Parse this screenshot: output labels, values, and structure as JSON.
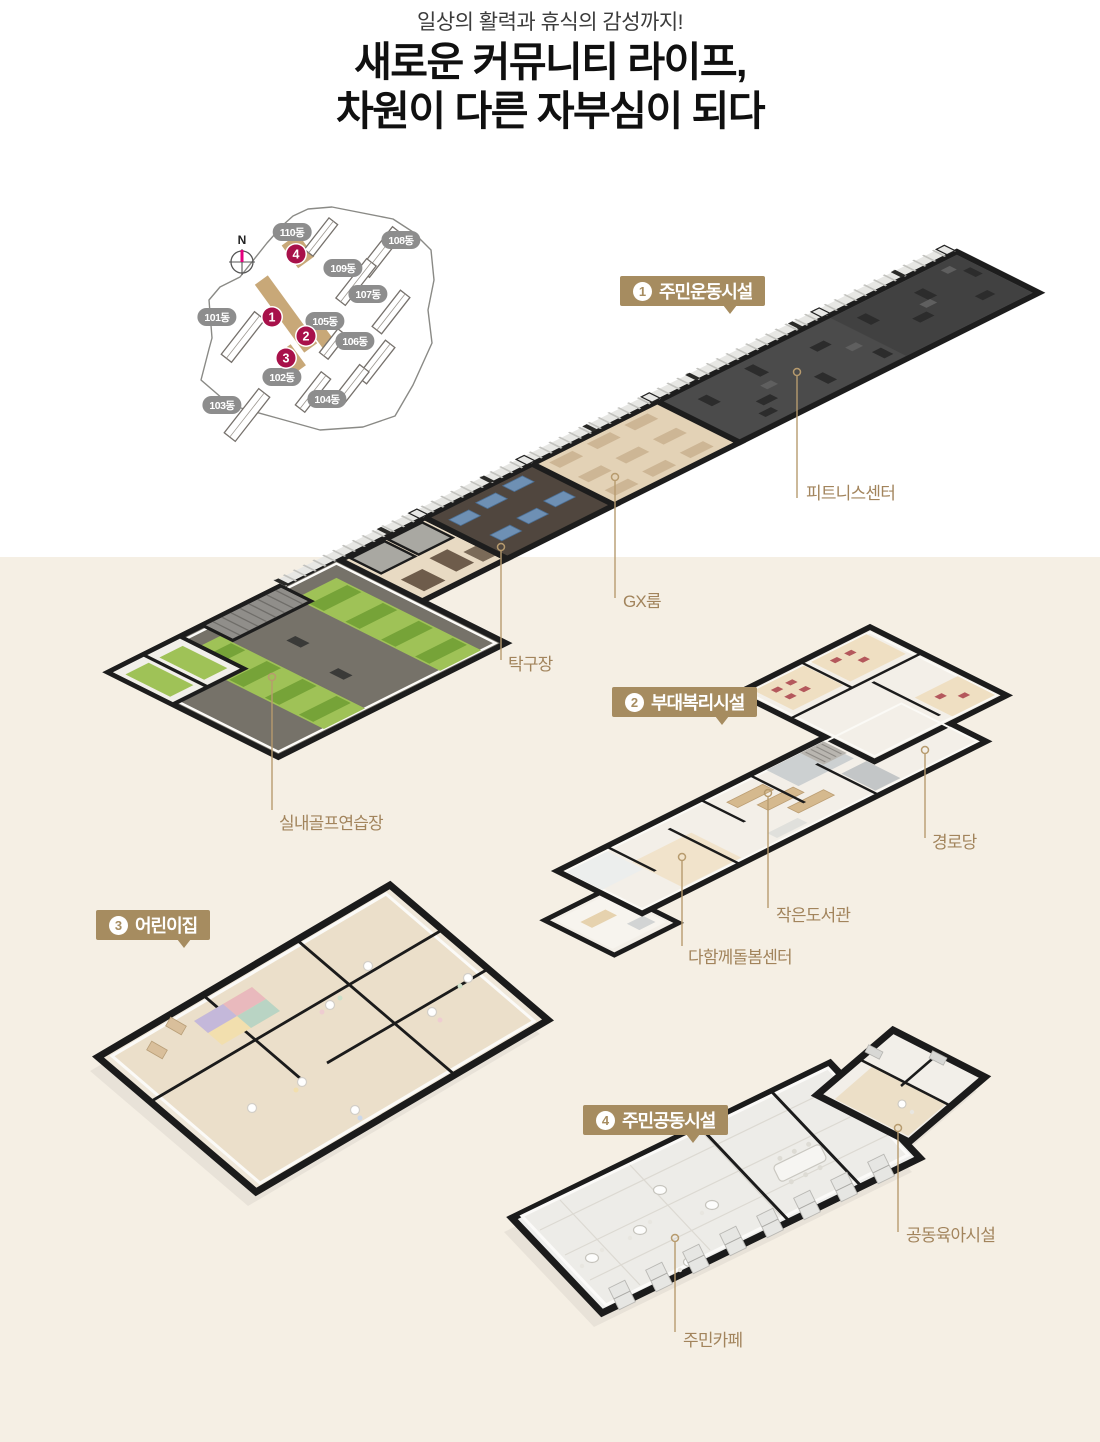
{
  "header": {
    "subtitle": "일상의 활력과 휴식의 감성까지!",
    "title_line1": "새로운 커뮤니티 라이프,",
    "title_line2": "차원이 다른 자부심이 되다"
  },
  "sitemap": {
    "compass_label": "N",
    "buildings": [
      {
        "label": "110동"
      },
      {
        "label": "108동"
      },
      {
        "label": "109동"
      },
      {
        "label": "107동"
      },
      {
        "label": "101동"
      },
      {
        "label": "105동"
      },
      {
        "label": "106동"
      },
      {
        "label": "102동"
      },
      {
        "label": "104동"
      },
      {
        "label": "103동"
      }
    ],
    "markers": [
      {
        "number": "1"
      },
      {
        "number": "2"
      },
      {
        "number": "3"
      },
      {
        "number": "4"
      }
    ]
  },
  "facilities": [
    {
      "number": "1",
      "name": "주민운동시설",
      "rooms": [
        {
          "label": "피트니스센터"
        },
        {
          "label": "GX룸"
        },
        {
          "label": "탁구장"
        },
        {
          "label": "실내골프연습장"
        }
      ]
    },
    {
      "number": "2",
      "name": "부대복리시설",
      "rooms": [
        {
          "label": "경로당"
        },
        {
          "label": "작은도서관"
        },
        {
          "label": "다함께돌봄센터"
        }
      ]
    },
    {
      "number": "3",
      "name": "어린이집",
      "rooms": []
    },
    {
      "number": "4",
      "name": "주민공동시설",
      "rooms": [
        {
          "label": "공동육아시설"
        },
        {
          "label": "주민카페"
        }
      ]
    }
  ],
  "colors": {
    "badge_tan": "#a68c60",
    "label_gold": "#a2845c",
    "marker_crimson": "#a8114a",
    "facility_tan": "#c8a878",
    "compass_north": "#e5007e",
    "background_cream": "#f5efe4",
    "turf_green": "#9fc257",
    "fitness_floor": "#4b4b4b",
    "table_tennis_floor": "#50463e",
    "wood_floor": "#e3d2b6"
  }
}
